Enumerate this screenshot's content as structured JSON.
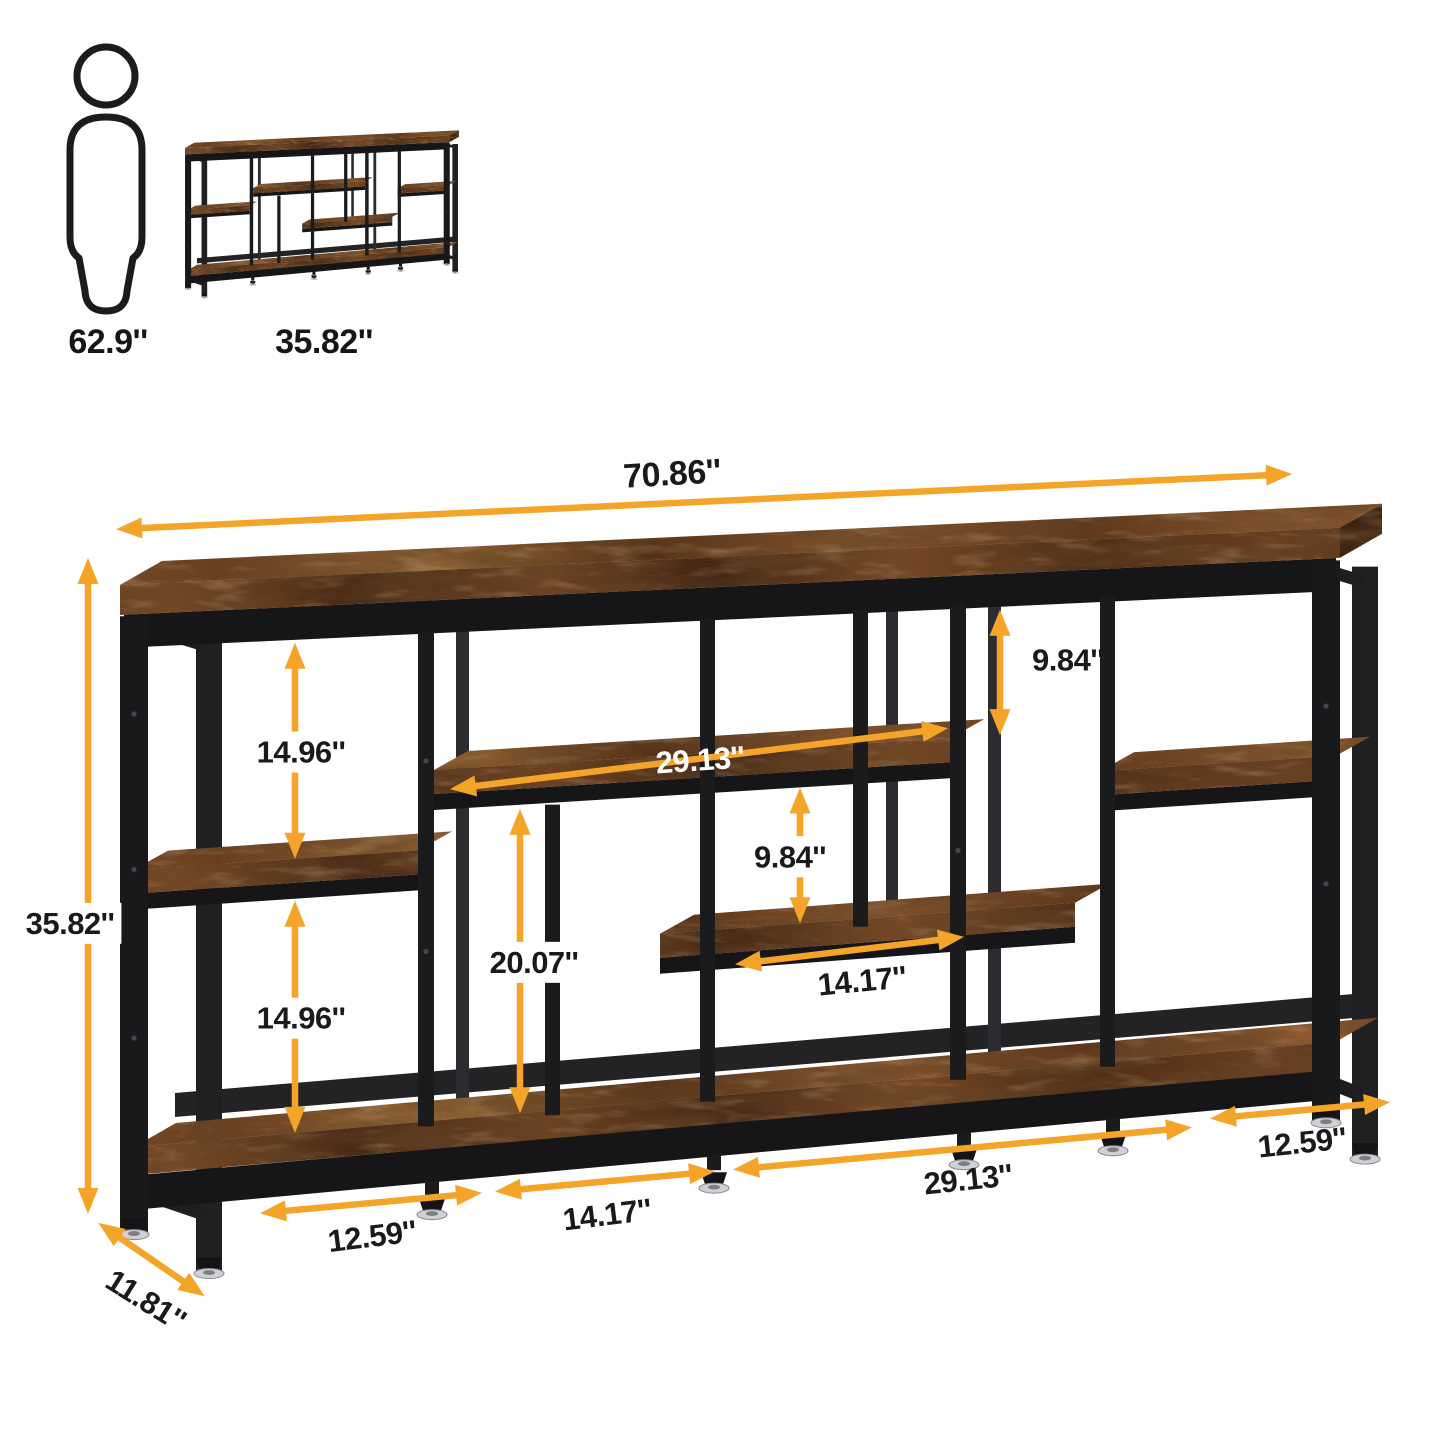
{
  "diagram_type": "furniture-dimension-diagram",
  "product": "industrial console table with open shelves",
  "scale_reference": {
    "person_height_label": "62.9''",
    "thumbnail_height_label": "35.82''"
  },
  "dimensions": {
    "overall_width": "70.86''",
    "overall_height": "35.82''",
    "overall_depth": "11.81''",
    "left_upper_gap": "14.96''",
    "left_lower_gap": "14.96''",
    "middle_shelf_width": "29.13''",
    "top_right_gap": "9.84''",
    "middle_gap": "9.84''",
    "center_height": "20.07''",
    "middle_shelf_section_width": "14.17''",
    "bottom_left_section": "12.59''",
    "bottom_second_section": "14.17''",
    "bottom_third_section": "29.13''",
    "bottom_right_section": "12.59''"
  },
  "colors": {
    "arrow": "#F4A428",
    "label_text": "#1A1A1A",
    "label_text_on_wood": "#FFFFFF",
    "metal_frame": "#1B1B1D",
    "wood_dark": "#432511",
    "wood_mid": "#7B4A26",
    "wood_light": "#9A6A38",
    "background": "#FFFFFF",
    "foot_silver": "#CFCFD4"
  }
}
